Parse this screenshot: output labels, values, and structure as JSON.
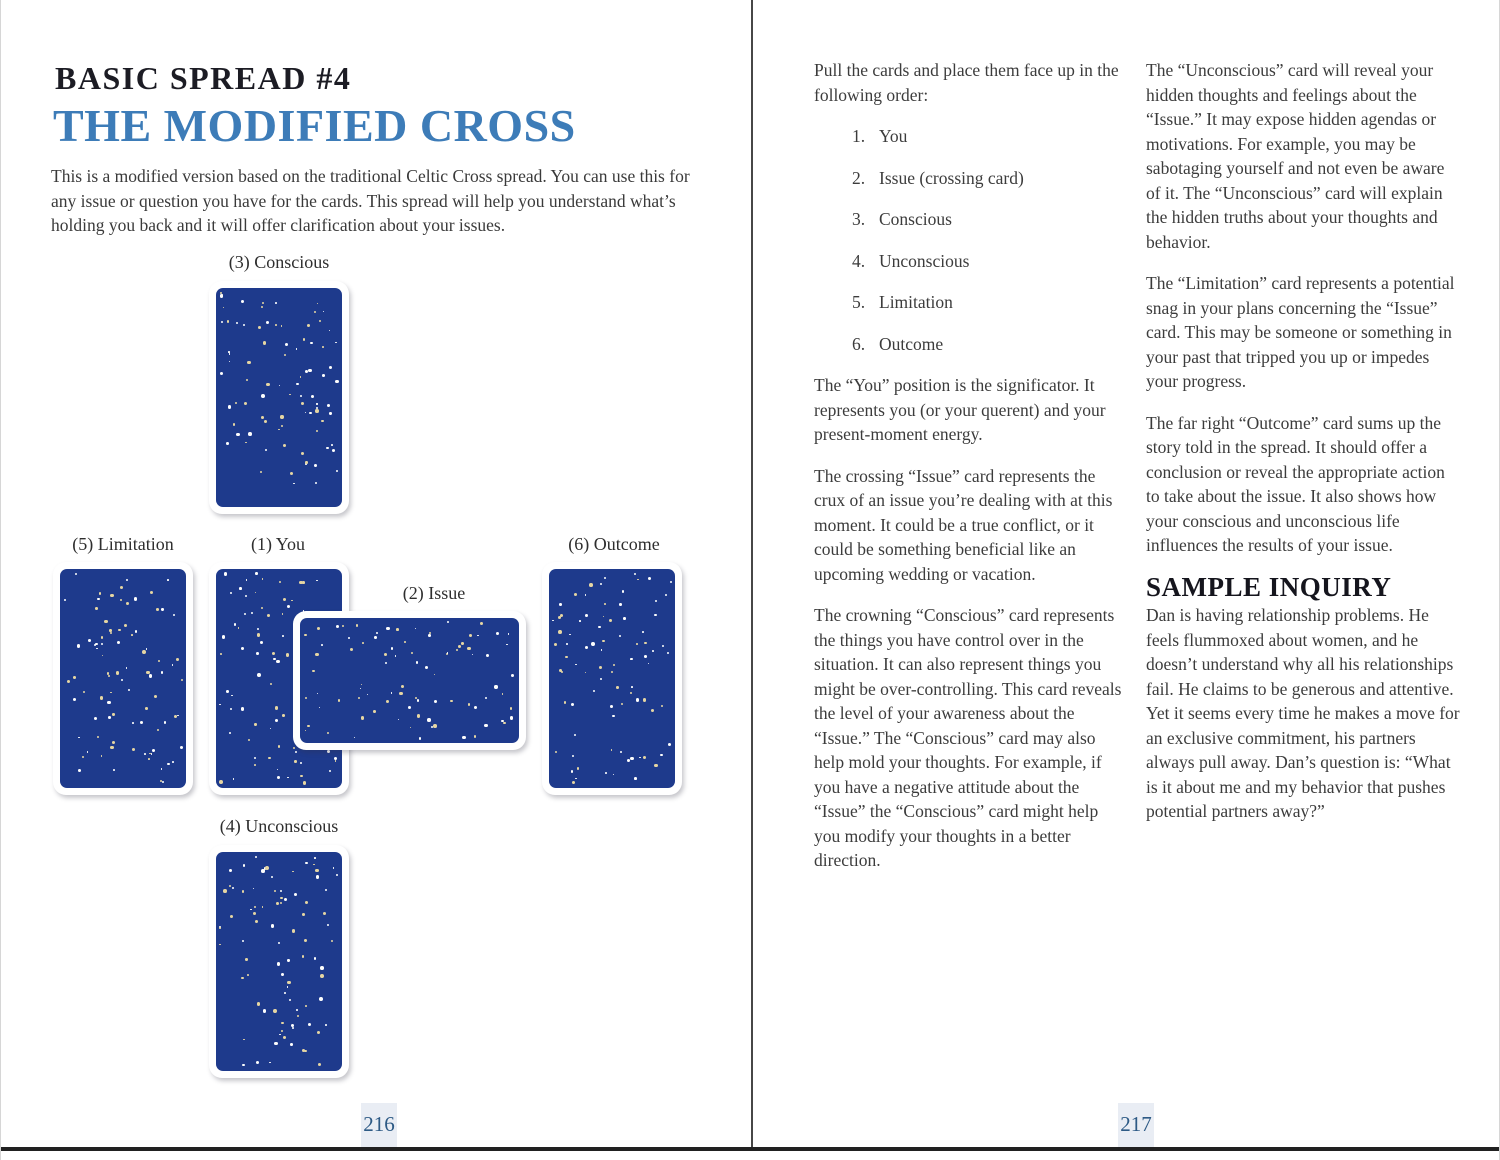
{
  "left": {
    "kicker": "BASIC SPREAD #4",
    "title": "THE MODIFIED CROSS",
    "intro": "This is a modified version based on the traditional Celtic Cross spread. You can use this for any issue or question you have for the cards. This spread will help you understand what’s holding you back and it will offer clarification about your issues.",
    "labels": {
      "conscious": "(3) Conscious",
      "limitation": "(5) Limitation",
      "you": "(1) You",
      "issue": "(2) Issue",
      "outcome": "(6) Outcome",
      "unconscious": "(4) Unconscious"
    },
    "folio": "216"
  },
  "right": {
    "col1": {
      "lead": "Pull the cards and place them face up in the following order:",
      "order_list": [
        {
          "num": "1.",
          "label": "You"
        },
        {
          "num": "2.",
          "label": "Issue (crossing card)"
        },
        {
          "num": "3.",
          "label": "Conscious"
        },
        {
          "num": "4.",
          "label": "Unconscious"
        },
        {
          "num": "5.",
          "label": "Limitation"
        },
        {
          "num": "6.",
          "label": "Outcome"
        }
      ],
      "para_you": "The “You” position is the significator. It represents you (or your querent) and your present-moment energy.",
      "para_issue": "The crossing “Issue” card represents the crux of an issue you’re dealing with at this moment. It could be a true conflict, or it could be something beneficial like an upcoming wedding or vacation.",
      "para_conscious": "The crowning “Conscious” card represents the things you have control over in the situation. It can also represent things you might be over-controlling. This card reveals the level of your awareness about the “Issue.” The “Conscious” card may also help mold your thoughts. For example, if you have a negative attitude about the “Issue” the “Conscious” card might help you modify your thoughts in a better direction."
    },
    "col2": {
      "para_unconscious": "The “Unconscious” card will reveal your hidden thoughts and feelings about the “Issue.” It may expose hidden agendas or motivations. For example, you may be sabotaging yourself and not even be aware of it. The “Unconscious” card will explain the hidden truths about your thoughts and behavior.",
      "para_limitation": "The “Limitation” card represents a potential snag in your plans concerning the “Issue” card. This may be someone or something in your past that tripped you up or impedes your progress.",
      "para_outcome": "The far right “Outcome” card sums up the story told in the spread. It should offer a conclusion or reveal the appropriate action to take about the issue. It also shows how your conscious and unconscious life influences the results of your issue.",
      "sample_heading": "SAMPLE INQUIRY",
      "sample_body": "Dan is having relationship problems. He feels flummoxed about women, and he doesn’t understand why all his relationships fail. He claims to be generous and attentive. Yet it seems every time he makes a move for an exclusive commitment, his partners always pull away. Dan’s question is: “What is it about me and my behavior that pushes potential partners away?”"
    },
    "folio": "217"
  },
  "colors": {
    "title_blue": "#3d7cb8",
    "card_navy": "#1e3a8c",
    "star_white": "#fdfdfd",
    "star_gold": "#e6d6a3",
    "folio_text": "#2d5a85",
    "folio_bg": "#e9edf4",
    "body_text": "#3c3c3c"
  }
}
